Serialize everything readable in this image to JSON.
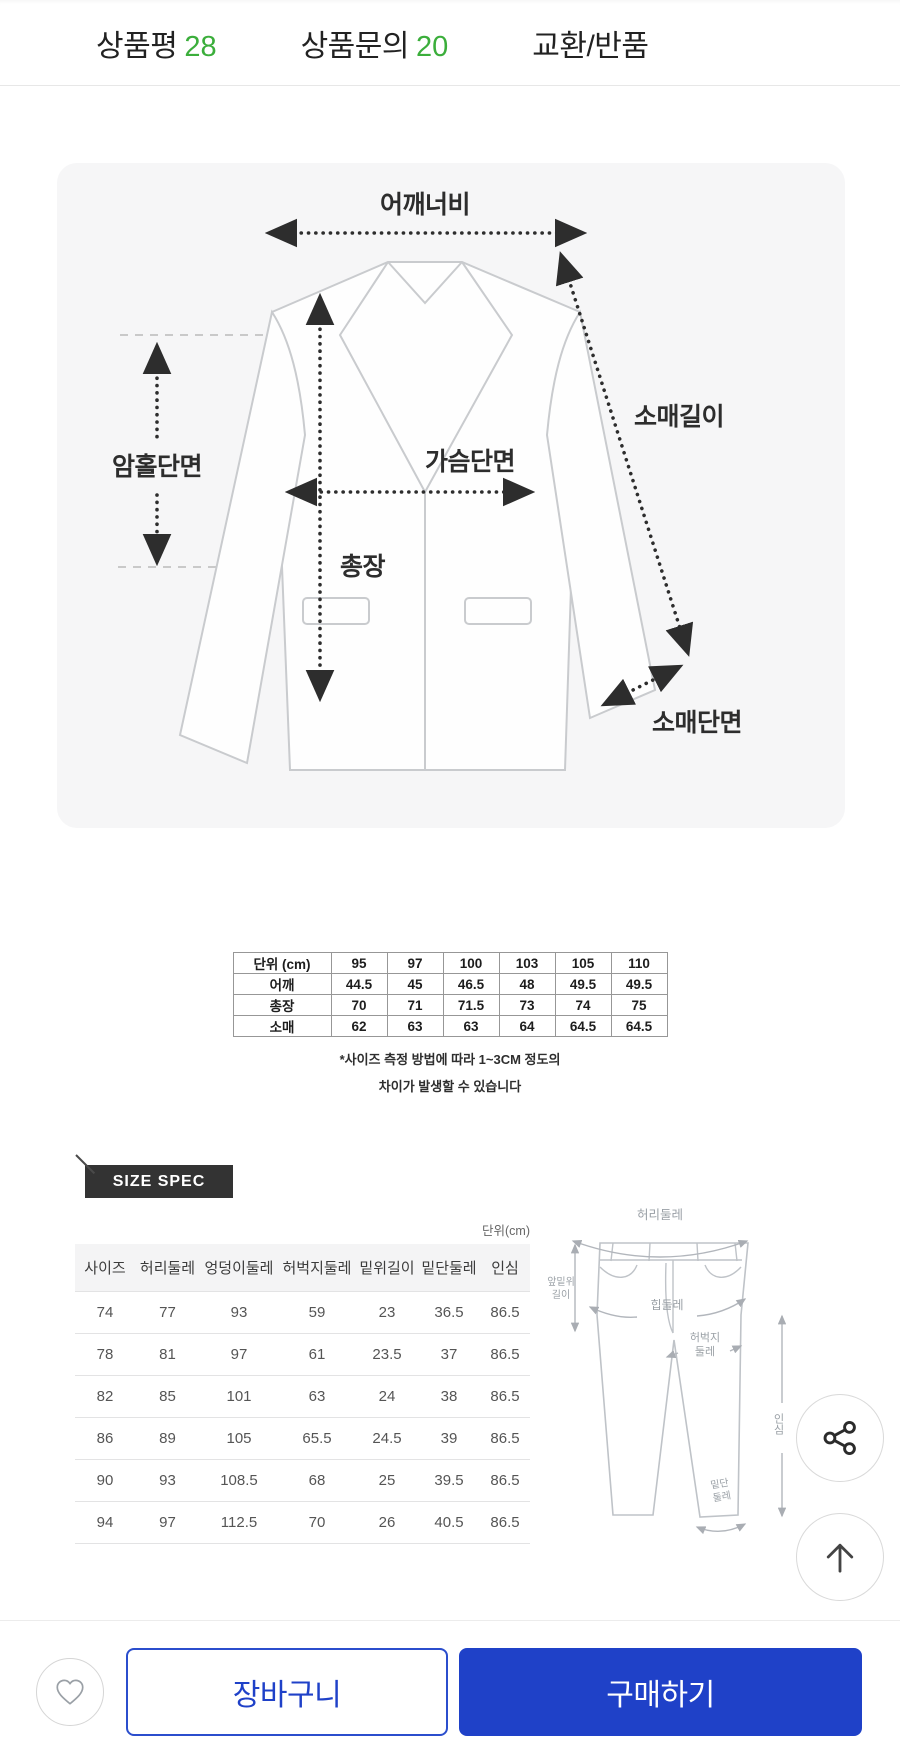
{
  "tabs": [
    {
      "label": "상품평",
      "count": "28"
    },
    {
      "label": "상품문의",
      "count": "20"
    },
    {
      "label": "교환/반품",
      "count": ""
    }
  ],
  "jacket_diagram": {
    "shoulder_width": "어깨너비",
    "armhole": "암홀단면",
    "sleeve_length": "소매길이",
    "chest_width": "가슴단면",
    "total_length": "총장",
    "sleeve_hem": "소매단면"
  },
  "jacket_size_table": {
    "header": [
      "단위 (cm)",
      "95",
      "97",
      "100",
      "103",
      "105",
      "110"
    ],
    "rows": [
      [
        "어깨",
        "44.5",
        "45",
        "46.5",
        "48",
        "49.5",
        "49.5"
      ],
      [
        "총장",
        "70",
        "71",
        "71.5",
        "73",
        "74",
        "75"
      ],
      [
        "소매",
        "62",
        "63",
        "63",
        "64",
        "64.5",
        "64.5"
      ]
    ],
    "note_line1": "*사이즈 측정 방법에 따라 1~3CM 정도의",
    "note_line2": "차이가 발생할 수 있습니다"
  },
  "size_spec": {
    "title": "SIZE SPEC",
    "unit_label": "단위(cm)",
    "columns": [
      "사이즈",
      "허리둘레",
      "엉덩이둘레",
      "허벅지둘레",
      "밑위길이",
      "밑단둘레",
      "인심"
    ],
    "rows": [
      [
        "74",
        "77",
        "93",
        "59",
        "23",
        "36.5",
        "86.5"
      ],
      [
        "78",
        "81",
        "97",
        "61",
        "23.5",
        "37",
        "86.5"
      ],
      [
        "82",
        "85",
        "101",
        "63",
        "24",
        "38",
        "86.5"
      ],
      [
        "86",
        "89",
        "105",
        "65.5",
        "24.5",
        "39",
        "86.5"
      ],
      [
        "90",
        "93",
        "108.5",
        "68",
        "25",
        "39.5",
        "86.5"
      ],
      [
        "94",
        "97",
        "112.5",
        "70",
        "26",
        "40.5",
        "86.5"
      ]
    ],
    "pants_diagram": {
      "waist": "허리둘레",
      "front_rise_line1": "앞밑위",
      "front_rise_line2": "길이",
      "hip": "힙둘레",
      "thigh_line1": "허벅지",
      "thigh_line2": "둘레",
      "inseam": "인심",
      "hem_line1": "밑단",
      "hem_line2": "둘레"
    }
  },
  "floating_buttons": {
    "share_icon": "share-icon",
    "top_icon": "arrow-up-icon"
  },
  "bottom_bar": {
    "wishlist_icon": "heart-icon",
    "cart_label": "장바구니",
    "buy_label": "구매하기"
  },
  "colors": {
    "accent_green": "#3bae3b",
    "accent_blue": "#1f41c8",
    "badge_bg": "#333333"
  }
}
